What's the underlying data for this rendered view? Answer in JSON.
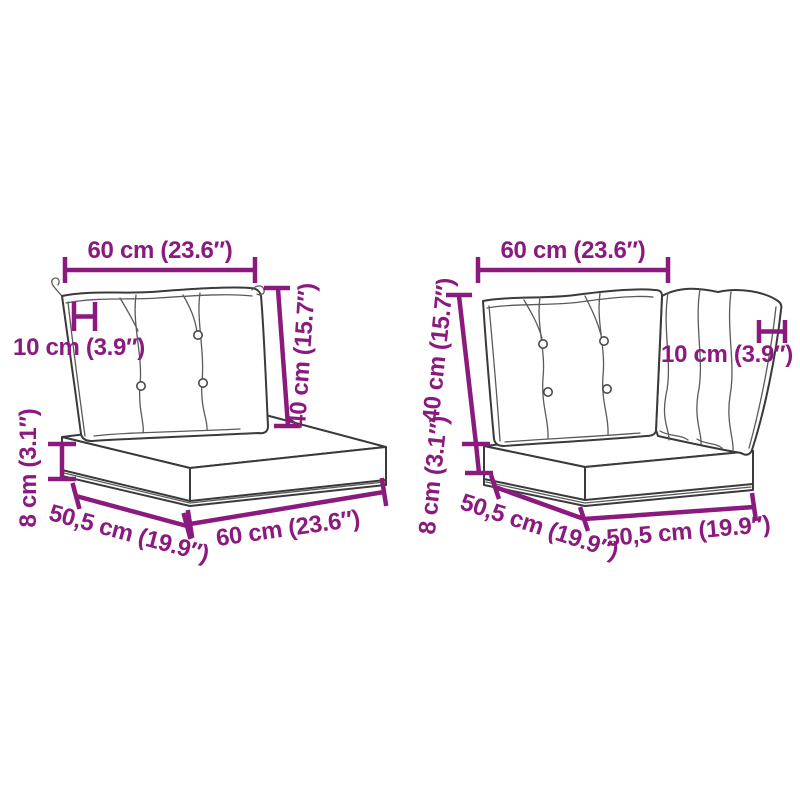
{
  "diagram": {
    "description": "Pallet cushion sets with dimension callouts",
    "colors": {
      "dimension_accent": "#8b1a7e",
      "line_art": "#3a3a3a",
      "background": "#ffffff"
    },
    "figures": {
      "left": {
        "name": "pallet cushion set: back cushion and seat cushion",
        "dims": {
          "top_width": "60 cm (23.6″)",
          "back_thickness": "10 cm (3.9″)",
          "back_height": "40 cm (15.7″)",
          "seat_thickness": "8 cm (3.1″)",
          "seat_depth": "50,5 cm (19.9″)",
          "seat_width": "60 cm (23.6″)"
        }
      },
      "right": {
        "name": "corner pallet cushion set: two back cushions and seat cushion",
        "dims": {
          "top_width": "60 cm (23.6″)",
          "back_thickness": "10 cm (3.9″)",
          "back_height": "40 cm (15.7″)",
          "seat_thickness": "8 cm (3.1″)",
          "seat_depth": "50,5 cm (19.9″)",
          "seat_width": "50,5 cm (19.9″)"
        }
      }
    }
  }
}
